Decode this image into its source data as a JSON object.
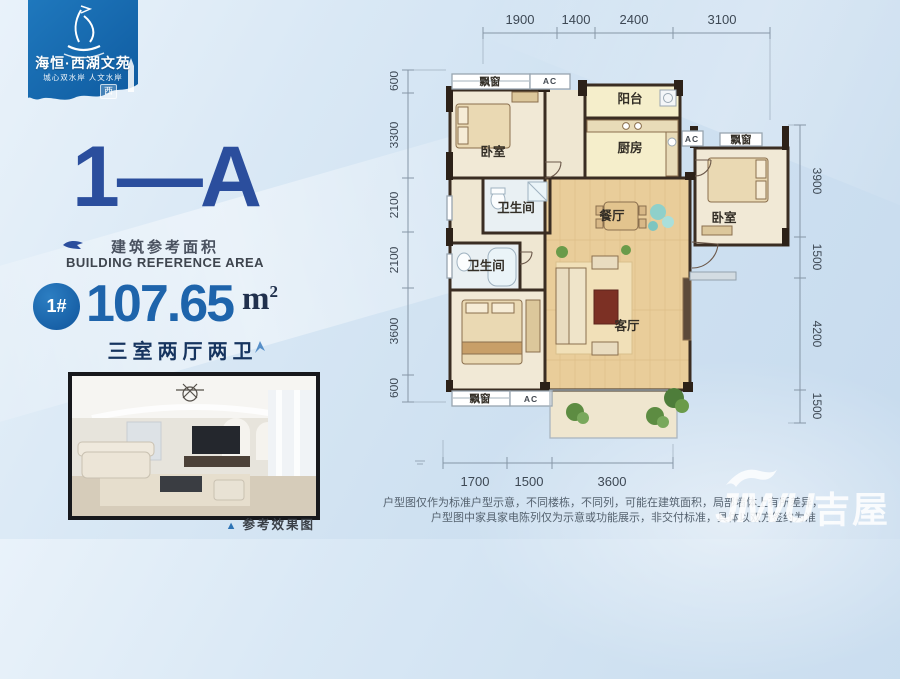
{
  "brand": {
    "name": "海恒·西湖文苑",
    "tagline": "城心双水岸 人文水岸",
    "seal": "西"
  },
  "unit": {
    "code": "1—A",
    "area_label_cn": "建筑参考面积",
    "area_label_en": "BUILDING REFERENCE AREA",
    "badge": "1#",
    "area_value": "107.65",
    "area_unit": "m",
    "area_exp": "2",
    "layout": "三室两厅两卫"
  },
  "photo": {
    "marker": "▲",
    "caption": "参考效果图"
  },
  "plan": {
    "rooms": {
      "bedroom": "卧室",
      "bedroom2": "卧室",
      "balcony": "阳台",
      "kitchen": "厨房",
      "bath": "卫生间",
      "bath2": "卫生间",
      "dining": "餐厅",
      "living": "客厅",
      "bay_window": "飘窗",
      "ac": "AC"
    },
    "dims_top": [
      "1900",
      "1400",
      "2400",
      "3100"
    ],
    "dims_left": [
      "600",
      "3300",
      "2100",
      "2100",
      "3600",
      "600"
    ],
    "dims_right": [
      "3900",
      "1500",
      "4200",
      "1500"
    ],
    "dims_bottom": [
      "1700",
      "1500",
      "3600"
    ]
  },
  "disclaimer": {
    "line1": "户型图仅作为标准户型示意，不同楼栋，不同列，可能在建筑面积，局部墙体上有所差异，",
    "line2": "户型图中家具家电陈列仅为示意或功能展示，非交付标准，具体以双方签约为准"
  },
  "watermark": {
    "latin": "JIWU",
    "cn": "吉屋"
  },
  "colors": {
    "brand_blue": "#1566ad",
    "navy": "#2b4e9d",
    "area_blue": "#1e64ab",
    "wall": "#382c21",
    "wood": "#e9cd9a",
    "cream": "#f1e9d6",
    "pale_yellow": "#f5eecb"
  }
}
